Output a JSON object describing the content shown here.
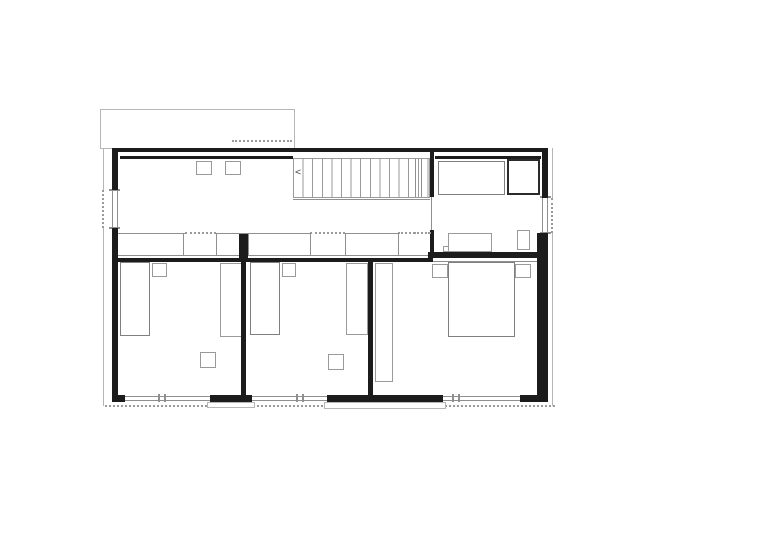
{
  "page": {
    "background": "#ffffff"
  },
  "colors": {
    "wall": "#1c1c1c",
    "interior_line": "#8f8f8f",
    "context_line": "#b6b6b6",
    "fixture_outline": "#9a9a9a",
    "shower_outline": "#2b2b2b"
  },
  "stair": {
    "direction_glyph": "<",
    "treads": 14
  },
  "elements": [
    {
      "n": "roof-outline-upper-floor",
      "css": "lrect",
      "x": 100,
      "y": 109,
      "w": 195,
      "h": 40
    },
    {
      "n": "roof-dashed-edge-top",
      "css": "doth",
      "x": 232,
      "y": 140,
      "w": 60,
      "h": 2
    },
    {
      "n": "site-line-left-upper",
      "css": "lline",
      "x": 103,
      "y": 148,
      "w": 1,
      "h": 42
    },
    {
      "n": "site-line-left-dashed",
      "css": "dotv",
      "x": 102,
      "y": 190,
      "w": 2,
      "h": 38
    },
    {
      "n": "site-line-left-lower",
      "css": "lline",
      "x": 103,
      "y": 228,
      "w": 1,
      "h": 178
    },
    {
      "n": "site-line-right-upper",
      "css": "lline",
      "x": 552,
      "y": 148,
      "w": 1,
      "h": 50
    },
    {
      "n": "site-line-right-dashed",
      "css": "dotv",
      "x": 551,
      "y": 198,
      "w": 2,
      "h": 35
    },
    {
      "n": "site-line-right-lower",
      "css": "lline",
      "x": 552,
      "y": 233,
      "w": 1,
      "h": 173
    },
    {
      "n": "site-line-bottom-dashed",
      "css": "doth",
      "x": 105,
      "y": 405,
      "w": 450,
      "h": 2
    },
    {
      "n": "wardrobe-band-top-1",
      "css": "gline",
      "x": 118,
      "y": 233,
      "w": 67,
      "h": 1
    },
    {
      "n": "wardrobe-band-dotted-1",
      "css": "doth",
      "x": 185,
      "y": 232,
      "w": 31,
      "h": 2
    },
    {
      "n": "wardrobe-band-top-2",
      "css": "gline",
      "x": 216,
      "y": 233,
      "w": 94,
      "h": 1
    },
    {
      "n": "wardrobe-band-dotted-2",
      "css": "doth",
      "x": 310,
      "y": 232,
      "w": 35,
      "h": 2
    },
    {
      "n": "wardrobe-band-top-3",
      "css": "gline",
      "x": 345,
      "y": 233,
      "w": 53,
      "h": 1
    },
    {
      "n": "wardrobe-band-dotted-3",
      "css": "doth",
      "x": 398,
      "y": 232,
      "w": 32,
      "h": 2
    },
    {
      "n": "wardrobe-band-bottom",
      "css": "gline",
      "x": 118,
      "y": 255,
      "w": 315,
      "h": 1
    },
    {
      "n": "wardrobe-divider",
      "css": "gline",
      "x": 183,
      "y": 233,
      "w": 1,
      "h": 23
    },
    {
      "n": "wardrobe-divider",
      "css": "gline",
      "x": 216,
      "y": 233,
      "w": 1,
      "h": 23
    },
    {
      "n": "wardrobe-divider",
      "css": "gline",
      "x": 248,
      "y": 233,
      "w": 1,
      "h": 23
    },
    {
      "n": "wardrobe-divider",
      "css": "gline",
      "x": 310,
      "y": 233,
      "w": 1,
      "h": 23
    },
    {
      "n": "wardrobe-divider",
      "css": "gline",
      "x": 345,
      "y": 233,
      "w": 1,
      "h": 23
    },
    {
      "n": "wardrobe-divider",
      "css": "gline",
      "x": 398,
      "y": 233,
      "w": 1,
      "h": 23
    },
    {
      "n": "staircase",
      "css": "stairs",
      "x": 293,
      "y": 158,
      "w": 137,
      "h": 40
    },
    {
      "n": "staircase-bottom-line",
      "css": "gline",
      "x": 293,
      "y": 199,
      "w": 137,
      "h": 1
    },
    {
      "n": "staircase-landing-line",
      "css": "gline",
      "x": 415,
      "y": 159,
      "w": 1,
      "h": 38
    },
    {
      "n": "staircase-landing-line",
      "css": "gline",
      "x": 421,
      "y": 159,
      "w": 1,
      "h": 38
    },
    {
      "n": "stair-direction-arrow-icon",
      "css": "glyph",
      "x": 295,
      "y": 168,
      "w": 12,
      "h": 12,
      "ch": "<"
    },
    {
      "n": "hall-skylight-1",
      "css": "grect",
      "x": 196,
      "y": 161,
      "w": 16,
      "h": 14
    },
    {
      "n": "hall-skylight-2",
      "css": "grect",
      "x": 225,
      "y": 161,
      "w": 16,
      "h": 14
    },
    {
      "n": "bathtub",
      "css": "grect2",
      "x": 438,
      "y": 161,
      "w": 67,
      "h": 34
    },
    {
      "n": "shower",
      "css": "drect",
      "x": 507,
      "y": 159,
      "w": 33,
      "h": 36
    },
    {
      "n": "vanity",
      "css": "grect",
      "x": 448,
      "y": 233,
      "w": 44,
      "h": 19
    },
    {
      "n": "vanity-step",
      "css": "grect",
      "x": 443,
      "y": 246,
      "w": 6,
      "h": 6
    },
    {
      "n": "toilet",
      "css": "grect",
      "x": 517,
      "y": 230,
      "w": 13,
      "h": 20
    },
    {
      "n": "bedroom1-bed",
      "css": "grect2",
      "x": 120,
      "y": 262,
      "w": 30,
      "h": 74
    },
    {
      "n": "bedroom1-nightstand",
      "css": "grect",
      "x": 152,
      "y": 263,
      "w": 15,
      "h": 14
    },
    {
      "n": "bedroom1-closet",
      "css": "grect",
      "x": 220,
      "y": 263,
      "w": 22,
      "h": 74
    },
    {
      "n": "bedroom1-side-table",
      "css": "grect",
      "x": 200,
      "y": 352,
      "w": 16,
      "h": 16
    },
    {
      "n": "bedroom2-bed",
      "css": "grect2",
      "x": 250,
      "y": 262,
      "w": 30,
      "h": 73
    },
    {
      "n": "bedroom2-nightstand",
      "css": "grect",
      "x": 282,
      "y": 263,
      "w": 14,
      "h": 14
    },
    {
      "n": "bedroom2-closet",
      "css": "grect",
      "x": 346,
      "y": 263,
      "w": 22,
      "h": 72
    },
    {
      "n": "bedroom2-side-table",
      "css": "grect",
      "x": 328,
      "y": 354,
      "w": 16,
      "h": 16
    },
    {
      "n": "bedroom3-bed",
      "css": "grect2",
      "x": 448,
      "y": 262,
      "w": 67,
      "h": 75
    },
    {
      "n": "bedroom3-nightstand-left",
      "css": "grect",
      "x": 432,
      "y": 264,
      "w": 16,
      "h": 14
    },
    {
      "n": "bedroom3-nightstand-right",
      "css": "grect",
      "x": 515,
      "y": 264,
      "w": 16,
      "h": 14
    },
    {
      "n": "bedroom3-closet",
      "css": "grect",
      "x": 375,
      "y": 263,
      "w": 18,
      "h": 119
    },
    {
      "n": "window-west",
      "css": "winv",
      "x": 112,
      "y": 190,
      "w": 6,
      "h": 38
    },
    {
      "n": "window-west-sill",
      "css": "gline",
      "x": 109,
      "y": 189,
      "w": 11,
      "h": 2
    },
    {
      "n": "window-west-sill",
      "css": "gline",
      "x": 109,
      "y": 227,
      "w": 11,
      "h": 2
    },
    {
      "n": "window-east",
      "css": "winv",
      "x": 542,
      "y": 198,
      "w": 6,
      "h": 35
    },
    {
      "n": "window-east-sill",
      "css": "gline",
      "x": 540,
      "y": 196,
      "w": 11,
      "h": 2
    },
    {
      "n": "window-east-sill",
      "css": "gline",
      "x": 540,
      "y": 232,
      "w": 11,
      "h": 2
    },
    {
      "n": "window-south-1",
      "css": "winh",
      "x": 125,
      "y": 396,
      "w": 85,
      "h": 5
    },
    {
      "n": "window-south-1-mullion",
      "css": "gline",
      "x": 158,
      "y": 394,
      "w": 2,
      "h": 8
    },
    {
      "n": "window-south-1-mullion",
      "css": "gline",
      "x": 164,
      "y": 394,
      "w": 2,
      "h": 8
    },
    {
      "n": "window-south-2",
      "css": "winh",
      "x": 252,
      "y": 396,
      "w": 75,
      "h": 5
    },
    {
      "n": "window-south-2-mullion",
      "css": "gline",
      "x": 296,
      "y": 394,
      "w": 2,
      "h": 8
    },
    {
      "n": "window-south-2-mullion",
      "css": "gline",
      "x": 302,
      "y": 394,
      "w": 2,
      "h": 8
    },
    {
      "n": "window-south-3",
      "css": "winh",
      "x": 443,
      "y": 396,
      "w": 77,
      "h": 5
    },
    {
      "n": "window-south-3-mullion",
      "css": "gline",
      "x": 452,
      "y": 394,
      "w": 2,
      "h": 8
    },
    {
      "n": "window-south-3-mullion",
      "css": "gline",
      "x": 458,
      "y": 394,
      "w": 2,
      "h": 8
    },
    {
      "n": "pier-south-1-outer",
      "css": "lrect",
      "x": 207,
      "y": 402,
      "w": 48,
      "h": 6
    },
    {
      "n": "wall-south-center-outer",
      "css": "lrect",
      "x": 324,
      "y": 402,
      "w": 122,
      "h": 7
    },
    {
      "n": "wall-north",
      "css": "wall",
      "x": 112,
      "y": 148,
      "w": 436,
      "h": 4
    },
    {
      "n": "hall-inner-north-line",
      "css": "wall",
      "x": 120,
      "y": 156,
      "w": 173,
      "h": 3
    },
    {
      "n": "bath-inner-north-line",
      "css": "wall",
      "x": 435,
      "y": 156,
      "w": 106,
      "h": 3
    },
    {
      "n": "wall-west-upper",
      "css": "wall",
      "x": 112,
      "y": 148,
      "w": 6,
      "h": 42
    },
    {
      "n": "wall-west-lower",
      "css": "wall",
      "x": 112,
      "y": 228,
      "w": 6,
      "h": 174
    },
    {
      "n": "wall-east-upper",
      "css": "wall",
      "x": 542,
      "y": 148,
      "w": 6,
      "h": 50
    },
    {
      "n": "wall-east-lower",
      "css": "wall",
      "x": 537,
      "y": 233,
      "w": 11,
      "h": 169
    },
    {
      "n": "wall-south-corner-left",
      "css": "wall",
      "x": 112,
      "y": 395,
      "w": 13,
      "h": 7
    },
    {
      "n": "wall-south-pier-1",
      "css": "wall",
      "x": 210,
      "y": 395,
      "w": 42,
      "h": 7
    },
    {
      "n": "wall-south-center",
      "css": "wall",
      "x": 327,
      "y": 395,
      "w": 116,
      "h": 7
    },
    {
      "n": "wall-south-corner-right",
      "css": "wall",
      "x": 520,
      "y": 395,
      "w": 28,
      "h": 7
    },
    {
      "n": "partition-wall-1-stub",
      "css": "wall",
      "x": 239,
      "y": 234,
      "w": 9,
      "h": 28
    },
    {
      "n": "partition-wall-1",
      "css": "wall",
      "x": 241,
      "y": 262,
      "w": 5,
      "h": 133
    },
    {
      "n": "partition-wall-2",
      "css": "wall",
      "x": 368,
      "y": 262,
      "w": 5,
      "h": 133
    },
    {
      "n": "corridor-wall",
      "css": "wall",
      "x": 118,
      "y": 258,
      "w": 315,
      "h": 4
    },
    {
      "n": "bathroom-south-wall",
      "css": "wall",
      "x": 428,
      "y": 252,
      "w": 114,
      "h": 6
    },
    {
      "n": "bedroom3-north-face-line",
      "css": "gline",
      "x": 433,
      "y": 261,
      "w": 104,
      "h": 1
    },
    {
      "n": "bathroom-west-wall-upper",
      "css": "wall",
      "x": 430,
      "y": 148,
      "w": 4,
      "h": 49
    },
    {
      "n": "bathroom-west-wall-lower",
      "css": "wall",
      "x": 430,
      "y": 230,
      "w": 4,
      "h": 28
    },
    {
      "n": "bathroom-door-opening-line",
      "css": "gline",
      "x": 431,
      "y": 197,
      "w": 1,
      "h": 33
    },
    {
      "n": "bathroom-door-dashed-line",
      "css": "doth",
      "x": 414,
      "y": 232,
      "w": 17,
      "h": 2
    }
  ]
}
